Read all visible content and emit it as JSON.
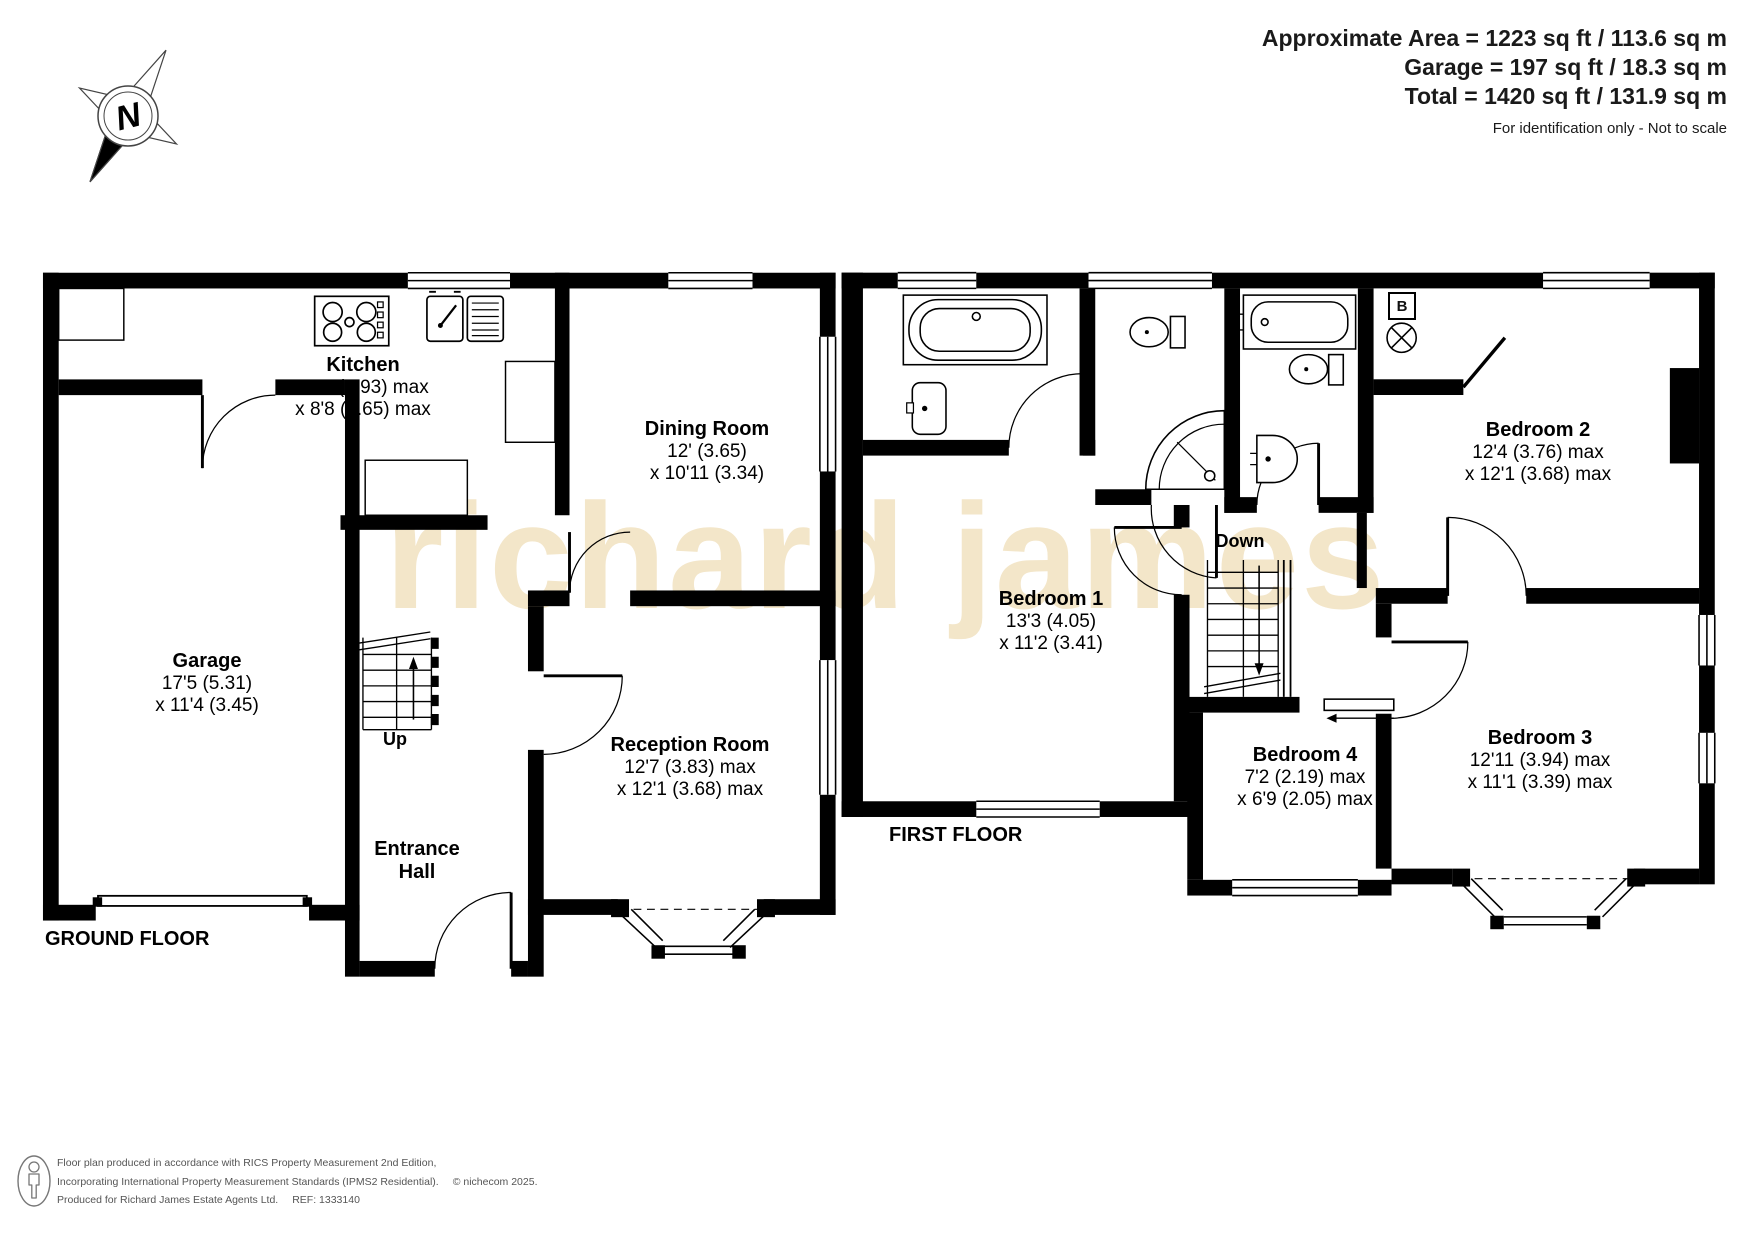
{
  "header": {
    "area_line1": "Approximate Area = 1223 sq ft / 113.6 sq m",
    "area_line2": "Garage = 197 sq ft / 18.3 sq m",
    "area_line3": "Total = 1420 sq ft / 131.9 sq m",
    "disclaimer": "For identification only - Not to scale"
  },
  "compass": {
    "north_label": "N"
  },
  "watermark": {
    "text": "richard james",
    "color": "#f3e6c9"
  },
  "ground_floor": {
    "label": "GROUND FLOOR",
    "stairs_label": "Up",
    "rooms": [
      {
        "id": "kitchen",
        "name": "Kitchen",
        "dims": [
          "19'5 (5.93) max",
          "x 8'8 (2.65) max"
        ]
      },
      {
        "id": "dining-room",
        "name": "Dining Room",
        "dims": [
          "12' (3.65)",
          "x 10'11 (3.34)"
        ]
      },
      {
        "id": "garage",
        "name": "Garage",
        "dims": [
          "17'5 (5.31)",
          "x 11'4 (3.45)"
        ]
      },
      {
        "id": "reception-room",
        "name": "Reception Room",
        "dims": [
          "12'7 (3.83) max",
          "x 12'1 (3.68) max"
        ]
      },
      {
        "id": "entrance-hall",
        "name": "Entrance Hall",
        "dims": []
      }
    ]
  },
  "first_floor": {
    "label": "FIRST FLOOR",
    "stairs_label": "Down",
    "boiler_label": "B",
    "rooms": [
      {
        "id": "bedroom-1",
        "name": "Bedroom 1",
        "dims": [
          "13'3 (4.05)",
          "x 11'2 (3.41)"
        ]
      },
      {
        "id": "bedroom-2",
        "name": "Bedroom 2",
        "dims": [
          "12'4 (3.76) max",
          "x 12'1 (3.68) max"
        ]
      },
      {
        "id": "bedroom-3",
        "name": "Bedroom 3",
        "dims": [
          "12'11 (3.94) max",
          "x 11'1 (3.39) max"
        ]
      },
      {
        "id": "bedroom-4",
        "name": "Bedroom 4",
        "dims": [
          "7'2 (2.19) max",
          "x 6'9 (2.05) max"
        ]
      }
    ]
  },
  "footer": {
    "line1": "Floor plan produced in accordance with RICS Property Measurement 2nd Edition,",
    "line2": "Incorporating International Property Measurement Standards (IPMS2 Residential).",
    "copyright": "© nichecom 2025.",
    "line3": "Produced for Richard James Estate Agents Ltd.",
    "ref": "REF: 1333140"
  }
}
